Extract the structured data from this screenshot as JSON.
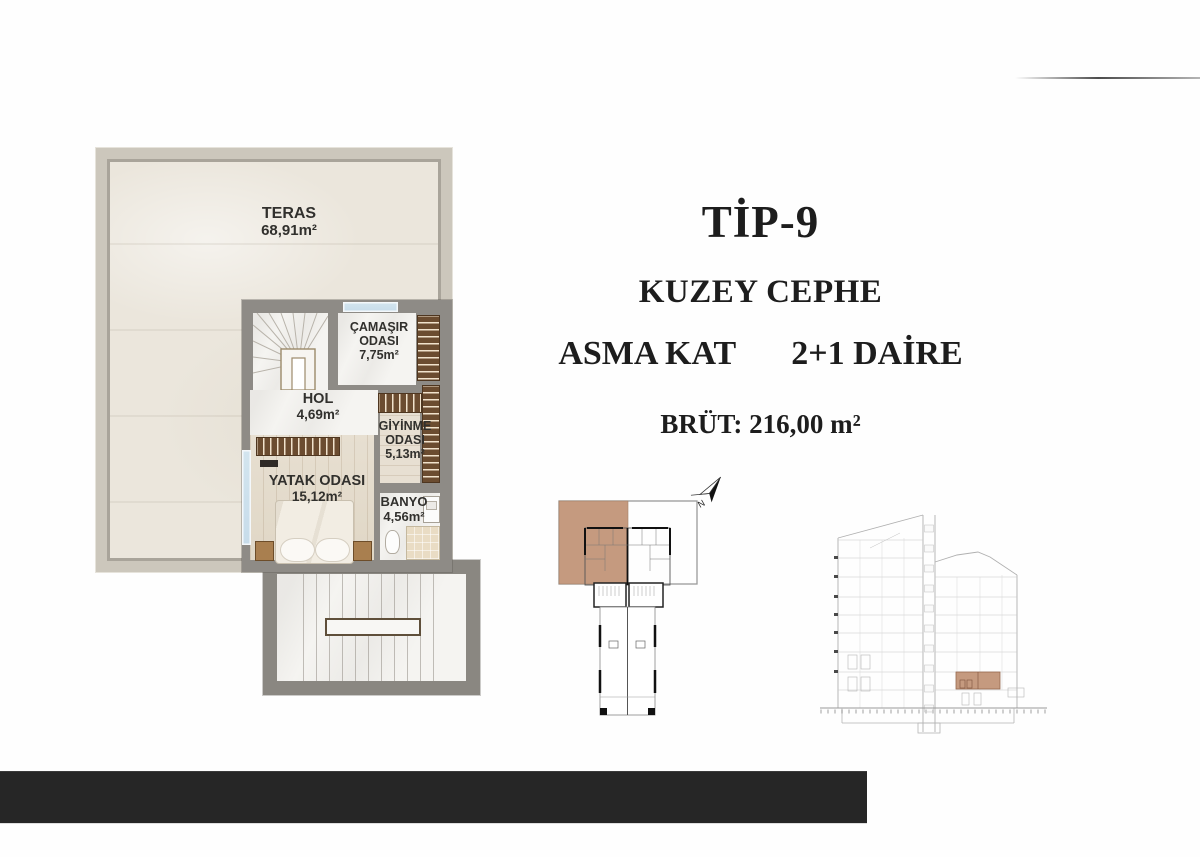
{
  "title_block": {
    "type_label": "TİP-9",
    "facade_label": "KUZEY CEPHE",
    "floor_label": "ASMA KAT",
    "unit_label": "2+1 DAİRE",
    "gross_area_label": "BRÜT: 216,00 m²"
  },
  "floor_plan": {
    "rooms": {
      "teras": {
        "name": "TERAS",
        "area": "68,91m²"
      },
      "camasir": {
        "name": "ÇAMAŞIR ODASI",
        "area": "7,75m²"
      },
      "hol": {
        "name": "HOL",
        "area": "4,69m²"
      },
      "giyinme": {
        "name": "GİYİNME ODASI",
        "area": "5,13m²"
      },
      "yatak": {
        "name": "YATAK ODASI",
        "area": "15,12m²"
      },
      "banyo": {
        "name": "BANYO",
        "area": "4,56m²"
      }
    }
  },
  "key_plan": {
    "north_label": "N"
  },
  "colors": {
    "highlight": "#c59a7f",
    "interior_wall": "#8e8b86",
    "terrace_wall": "#ccc7bc",
    "wardrobe": "#6b4c30",
    "window": "#cfe2ec",
    "bottom_bar": "#262626"
  }
}
